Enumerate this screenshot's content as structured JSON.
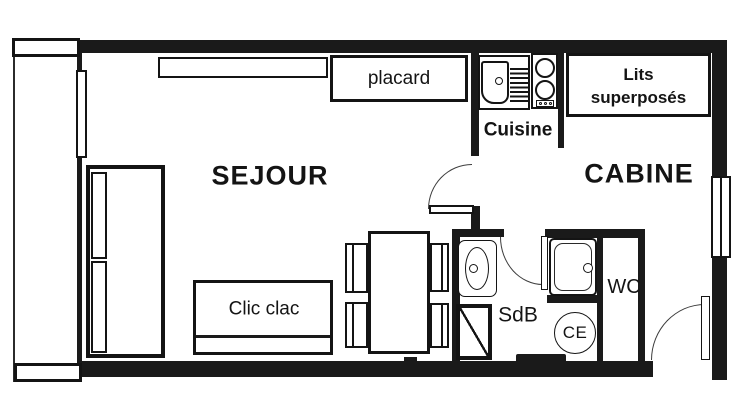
{
  "colors": {
    "ink": "#141414",
    "paper": "#ffffff"
  },
  "rooms": {
    "sejour": "SEJOUR",
    "cabine": "CABINE",
    "cuisine": "Cuisine",
    "sdb": "SdB",
    "wc": "WC"
  },
  "furniture": {
    "placard": "placard",
    "lits_line1": "Lits",
    "lits_line2": "superposés",
    "clic_clac": "Clic clac"
  },
  "fixtures": {
    "water_heater": "CE"
  }
}
